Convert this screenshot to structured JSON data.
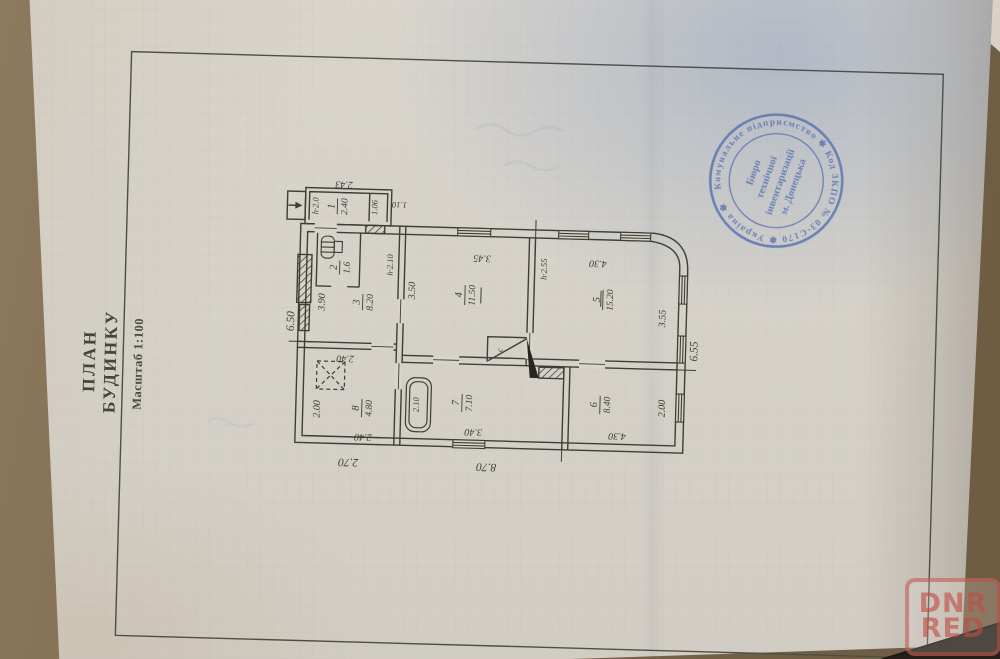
{
  "page": {
    "title_line1": "ПЛАН",
    "title_line2": "БУДИНКУ",
    "scale": "Масштаб 1:100"
  },
  "stamp": {
    "ring_text": "Комунальне підприємство ✱ Код ЗКПО № 03·С170 ✱ Україна ✱",
    "center_lines": [
      "Бюро",
      "технічної",
      "інвентаризації",
      "м. Донецька"
    ],
    "ink_color": "#5570b0"
  },
  "watermark": {
    "line1": "DNR",
    "line2": "RED",
    "color": "#c14c42"
  },
  "plan": {
    "rooms": [
      {
        "number": "1",
        "area": "2.40"
      },
      {
        "number": "2",
        "area": "1.6"
      },
      {
        "number": "3",
        "area": "8.20"
      },
      {
        "number": "4",
        "area": "11.50"
      },
      {
        "number": "5",
        "area": "15.20"
      },
      {
        "number": "6",
        "area": "8.40"
      },
      {
        "number": "7",
        "area": "7.10"
      },
      {
        "number": "8",
        "area": "4.80"
      }
    ],
    "dims": {
      "t243": "2.43",
      "t110": "1.10",
      "t106": "1.06",
      "h20": "h·2.0",
      "t650": "6.50",
      "t390": "3.90",
      "t200a": "2.00",
      "t240a": "2.40",
      "t240b": "2.40",
      "t270": "2.70",
      "t870": "8.70",
      "t350": "3.50",
      "t345": "3.45",
      "t430a": "4.30",
      "h210": "h·2.10",
      "h255": "h·2.55",
      "t355": "3.55",
      "t655": "6.55",
      "t200b": "2.00",
      "t340": "3.40",
      "t430b": "4.30",
      "t210": "2.10",
      "closet": "с"
    }
  }
}
